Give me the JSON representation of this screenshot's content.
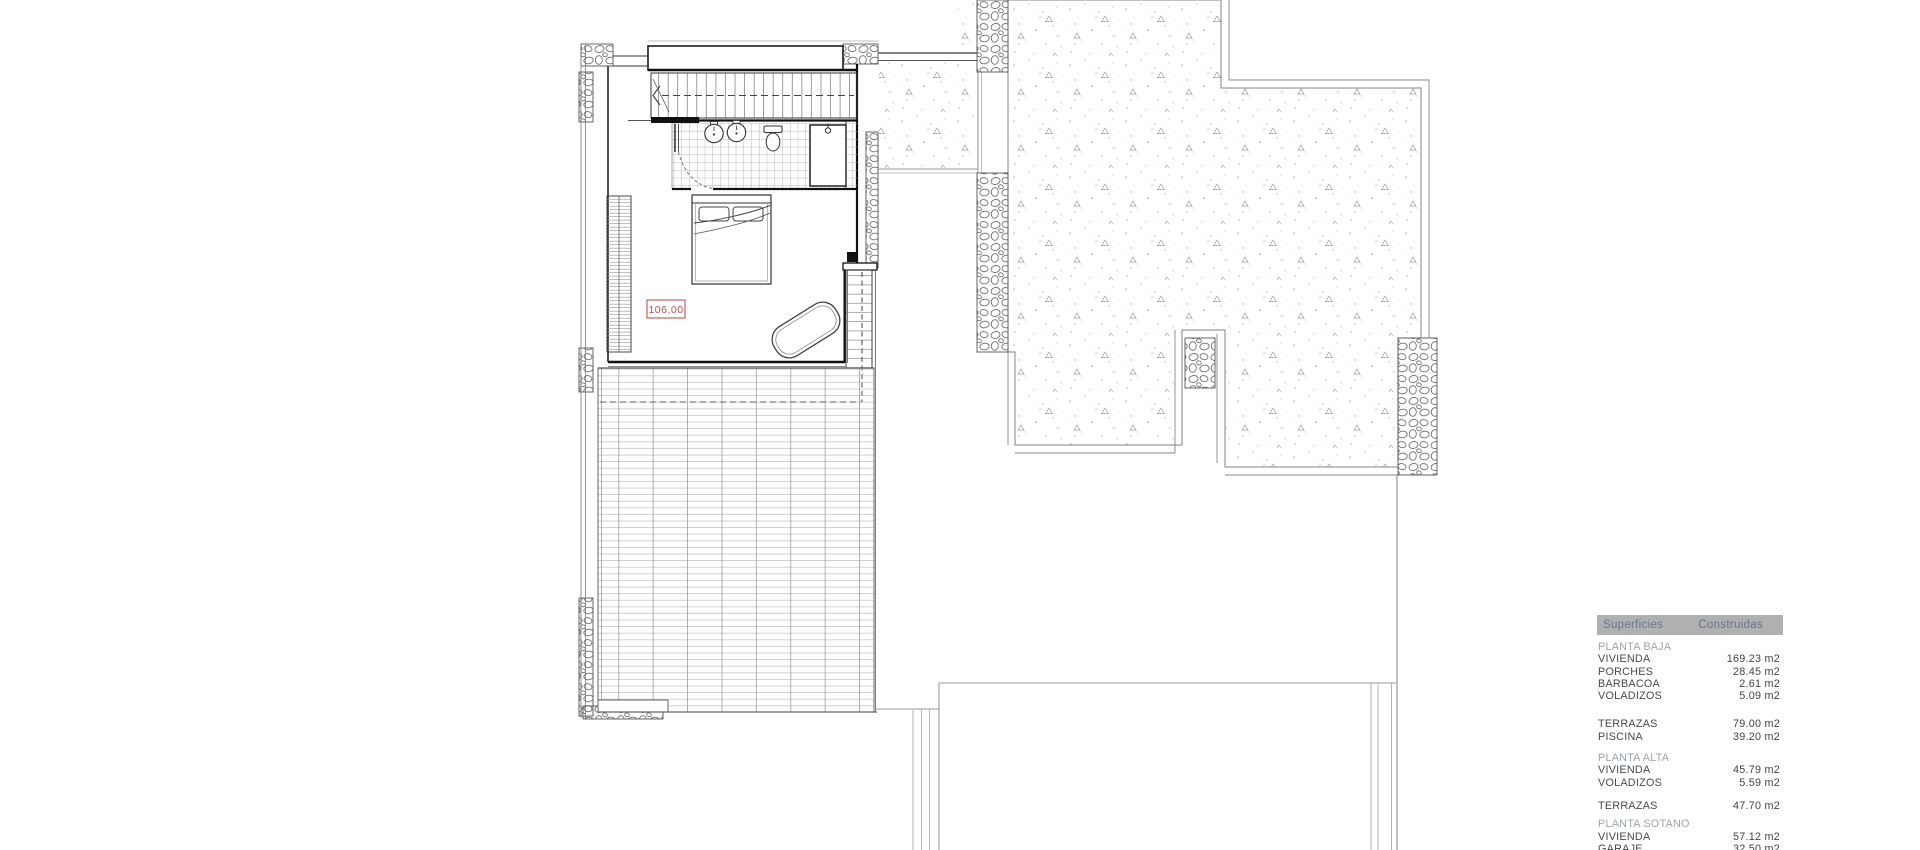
{
  "drawing": {
    "level_label": "106,00",
    "colors": {
      "accent_red": "#bf4f4f",
      "line_dark": "#1a1a1a",
      "line_gray": "#808080",
      "table_header_bg": "#b1b0b0",
      "table_header_text": "#67758a",
      "table_section_text": "#9aa5b0",
      "table_item_text": "#46494d"
    }
  },
  "areas_table": {
    "header": {
      "col1": "Superficies",
      "col2": "Construidas"
    },
    "rows": [
      {
        "type": "spacer",
        "h": 6
      },
      {
        "type": "section",
        "label": "PLANTA BAJA"
      },
      {
        "type": "item",
        "label": "VIVIENDA",
        "value": "169.23 m2"
      },
      {
        "type": "item",
        "label": "PORCHES",
        "value": "28.45 m2"
      },
      {
        "type": "item",
        "label": "BARBACOA",
        "value": "2.61 m2"
      },
      {
        "type": "item",
        "label": "VOLADIZOS",
        "value": "5.09 m2"
      },
      {
        "type": "spacer",
        "h": 16
      },
      {
        "type": "item",
        "label": "TERRAZAS",
        "value": "79.00 m2"
      },
      {
        "type": "item",
        "label": "PISCINA",
        "value": "39.20 m2"
      },
      {
        "type": "spacer",
        "h": 9
      },
      {
        "type": "section",
        "label": "PLANTA ALTA"
      },
      {
        "type": "item",
        "label": "VIVIENDA",
        "value": "45.79 m2"
      },
      {
        "type": "item",
        "label": "VOLADIZOS",
        "value": "5.59 m2"
      },
      {
        "type": "spacer",
        "h": 11
      },
      {
        "type": "item",
        "label": "TERRAZAS",
        "value": "47.70 m2"
      },
      {
        "type": "spacer",
        "h": 6
      },
      {
        "type": "section",
        "label": "PLANTA SOTANO"
      },
      {
        "type": "item",
        "label": "VIVIENDA",
        "value": "57.12 m2"
      },
      {
        "type": "item",
        "label": "GARAJE",
        "value": "32.50 m2"
      }
    ]
  }
}
